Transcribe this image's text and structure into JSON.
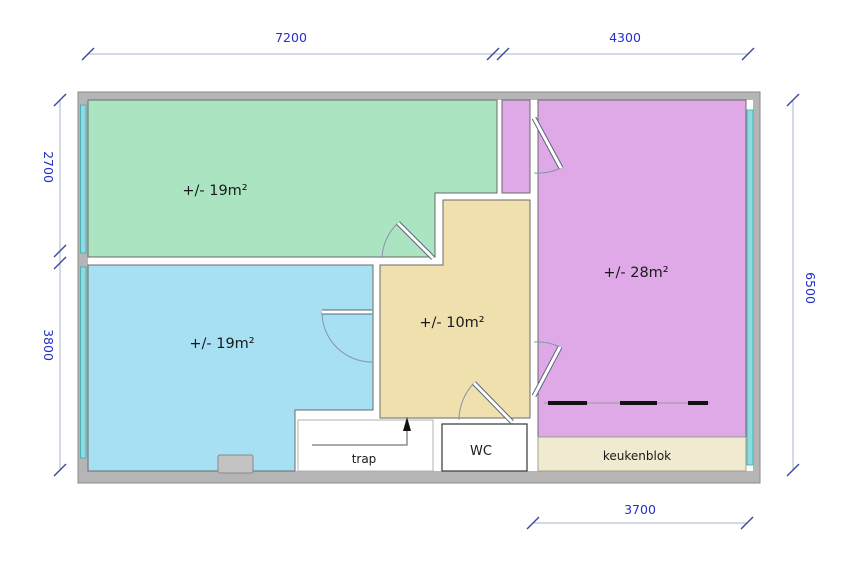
{
  "drawing_title": "floor plan",
  "colors": {
    "wall": "#b5b5b5",
    "wall_outline": "#8a8a8a",
    "interior": "#ffffff",
    "green_room": "#abe4c0",
    "blue_room": "#a7e0f3",
    "yellow_room": "#f0e0ae",
    "purple_room": "#dfa9e8",
    "kitchen_strip": "#f0ead0",
    "window_fill": "#8adce0",
    "chimney": "#c3c3c3",
    "stove": "#111111",
    "dim_text": "#2331c8"
  },
  "rooms": {
    "top_left": {
      "label": "+/- 19m²"
    },
    "bottom_left": {
      "label": "+/- 19m²"
    },
    "middle": {
      "label": "+/- 10m²"
    },
    "right": {
      "label": "+/- 28m²"
    }
  },
  "features": {
    "stairs": "trap",
    "toilet": "WC",
    "kitchen": "keukenblok"
  },
  "dimensions": {
    "top_left_width": "7200",
    "top_right_width": "4300",
    "left_upper_height": "2700",
    "left_lower_height": "3800",
    "right_height": "6500",
    "bottom_width": "3700"
  }
}
